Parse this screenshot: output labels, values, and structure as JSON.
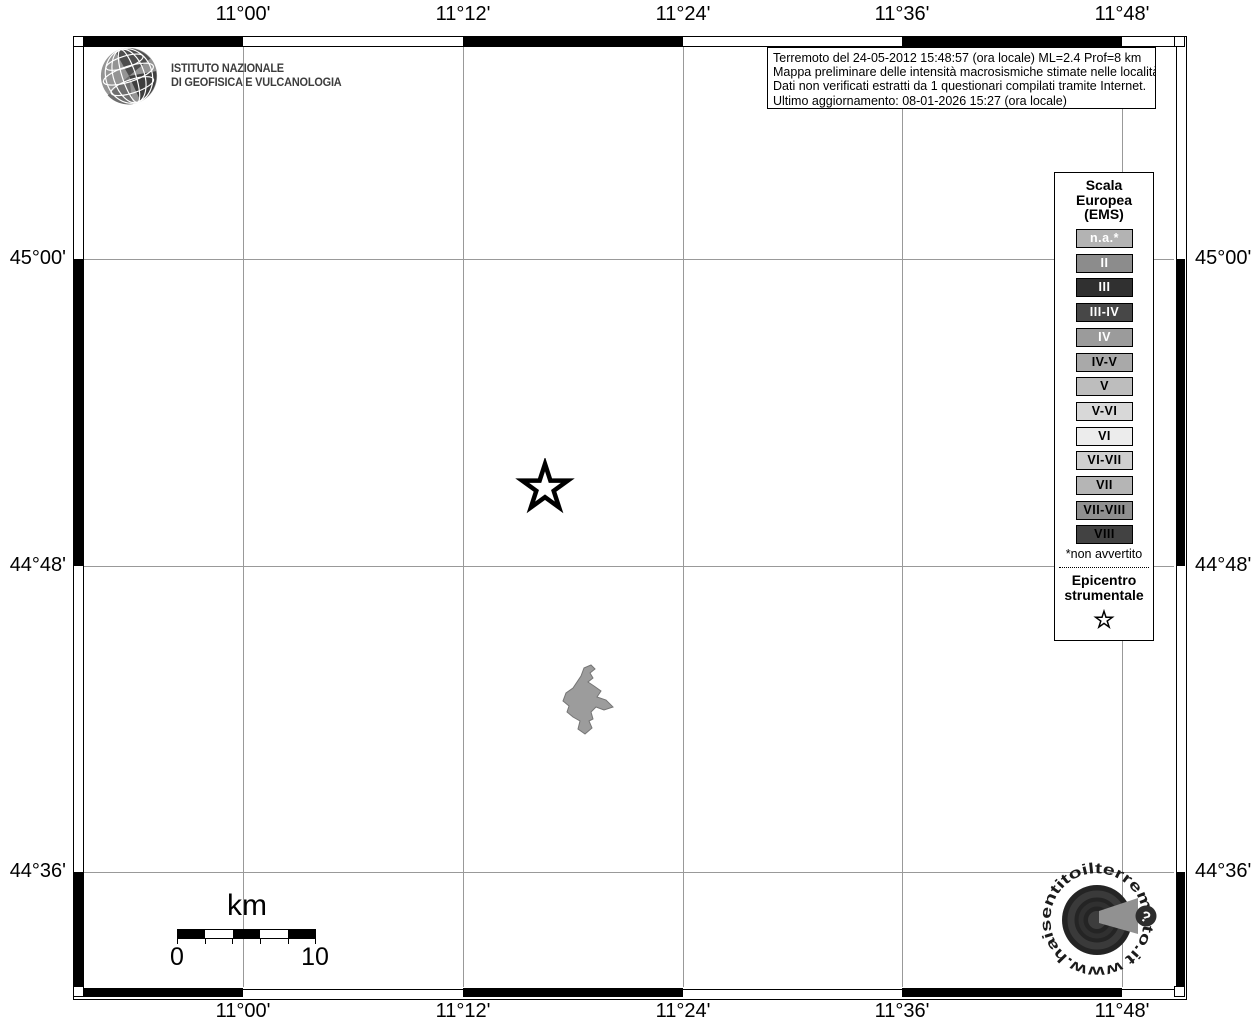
{
  "axes": {
    "top": [
      "11°00'",
      "11°12'",
      "11°24'",
      "11°36'",
      "11°48'"
    ],
    "bottom": [
      "11°00'",
      "11°12'",
      "11°24'",
      "11°36'",
      "11°48'"
    ],
    "left": [
      "45°00'",
      "44°48'",
      "44°36'"
    ],
    "right": [
      "45°00'",
      "44°48'",
      "44°36'"
    ]
  },
  "ingv": {
    "line1": "ISTITUTO NAZIONALE",
    "line2": "DI GEOFISICA E VULCANOLOGIA"
  },
  "info_box": {
    "line1": "Terremoto del 24-05-2012 15:48:57 (ora locale) ML=2.4 Prof=8 km",
    "line2": "Mappa preliminare delle intensità macrosismiche stimate nelle località",
    "line3": "Dati non verificati estratti da 1 questionari compilati tramite Internet.",
    "line4": "Ultimo aggiornamento: 08-01-2026 15:27 (ora locale)"
  },
  "legend": {
    "title1": "Scala",
    "title2": "Europea",
    "title3": "(EMS)",
    "items": [
      {
        "label": "n.a.*",
        "bg": "#b3b3b3",
        "fg": "#ffffff"
      },
      {
        "label": "II",
        "bg": "#8c8c8c",
        "fg": "#ffffff"
      },
      {
        "label": "III",
        "bg": "#303030",
        "fg": "#ffffff"
      },
      {
        "label": "III-IV",
        "bg": "#474747",
        "fg": "#ffffff"
      },
      {
        "label": "IV",
        "bg": "#9b9b9b",
        "fg": "#ffffff"
      },
      {
        "label": "IV-V",
        "bg": "#a9a9a9",
        "fg": "#000000"
      },
      {
        "label": "V",
        "bg": "#bdbdbd",
        "fg": "#000000"
      },
      {
        "label": "V-VI",
        "bg": "#d8d8d8",
        "fg": "#000000"
      },
      {
        "label": "VI",
        "bg": "#ececec",
        "fg": "#000000"
      },
      {
        "label": "VI-VII",
        "bg": "#cfcfcf",
        "fg": "#000000"
      },
      {
        "label": "VII",
        "bg": "#b5b5b5",
        "fg": "#000000"
      },
      {
        "label": "VII-VIII",
        "bg": "#8f8f8f",
        "fg": "#000000"
      },
      {
        "label": "VIII",
        "bg": "#424242",
        "fg": "#000000"
      }
    ],
    "footnote": "*non avvertito",
    "epicenter1": "Epicentro",
    "epicenter2": "strumentale"
  },
  "scale_bar": {
    "unit": "km",
    "start": "0",
    "end": "10"
  },
  "site_logo": {
    "text": "www.haisentitoilterremoto.it",
    "qmark": "?"
  },
  "colors": {
    "background": "#ffffff",
    "frame": "#000000",
    "grid": "#999999",
    "locality_fill": "#9c9c9c",
    "locality_stroke": "#757575"
  }
}
